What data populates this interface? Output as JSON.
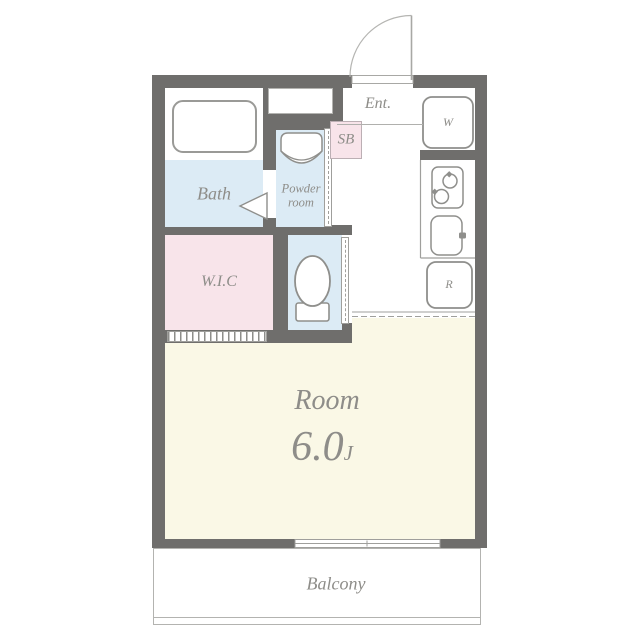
{
  "floorplan": {
    "labels": {
      "entrance": "Ent.",
      "washer": "W",
      "shoe_box": "SB",
      "bath": "Bath",
      "powder_line1": "Powder",
      "powder_line2": "room",
      "wic": "W.I.C",
      "refrigerator": "R",
      "room": "Room",
      "room_size": "6.0",
      "room_size_unit": "J",
      "balcony": "Balcony"
    },
    "colors": {
      "wall": "#6f6e6c",
      "water": "#dcebf5",
      "pink": "#f8e4ea",
      "cream": "#faf8e6",
      "text": "#8e8d89",
      "line": "#9f9f9c"
    },
    "icons": {
      "entrance_door": "quarter-circle swing arc with open leaf",
      "bathtub": "rounded rectangle tub",
      "washbasin": "rounded basin with curved front",
      "bath_door": "triangle fold-door marker",
      "toilet": "oval bowl with tank",
      "stove": "two-burner cooktop",
      "sink": "rounded sink with handle",
      "window": "sliding window in wall",
      "powder_door": "sliding door dashed track",
      "toilet_door": "sliding door dashed track",
      "wic_door": "striped closet door track"
    }
  }
}
